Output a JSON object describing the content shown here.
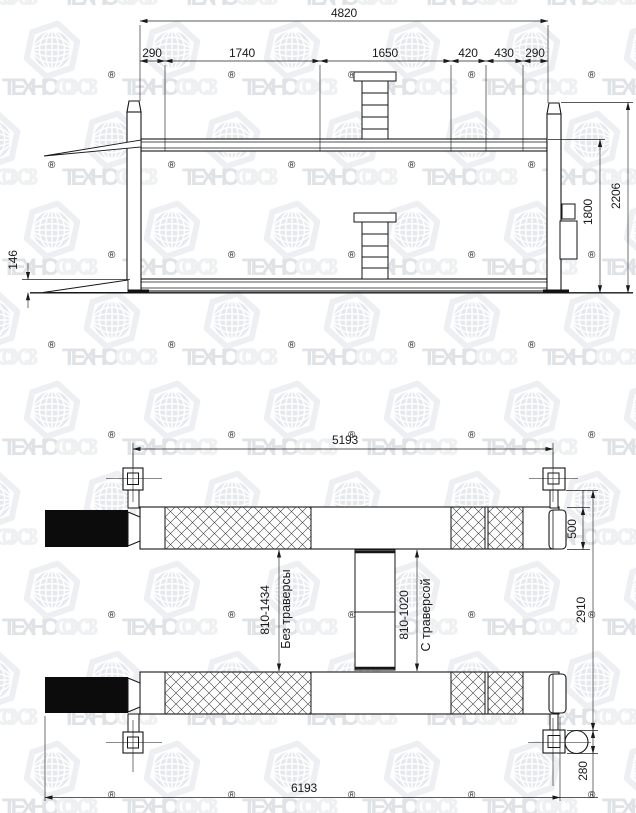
{
  "watermark": {
    "brand_bold": "ТЕХНО",
    "brand_light": "СОЮЗ",
    "registered": "®"
  },
  "side_view": {
    "dim_total_span": "4820",
    "dim_segments": [
      "290",
      "1740",
      "1650",
      "420",
      "430",
      "290"
    ],
    "dim_overall_height": "2206",
    "dim_max_lift_height": "1800",
    "dim_min_platform_height": "146"
  },
  "plan_view": {
    "dim_post_span": "5193",
    "dim_platform_width": "500",
    "dim_overall_width": "2910",
    "dim_range_without_traverse": "810-1434",
    "label_without_traverse": "Без траверсы",
    "dim_range_with_traverse": "810-1020",
    "label_with_traverse": "С траверсой",
    "dim_power_unit": "280",
    "dim_overall_length": "6193"
  }
}
